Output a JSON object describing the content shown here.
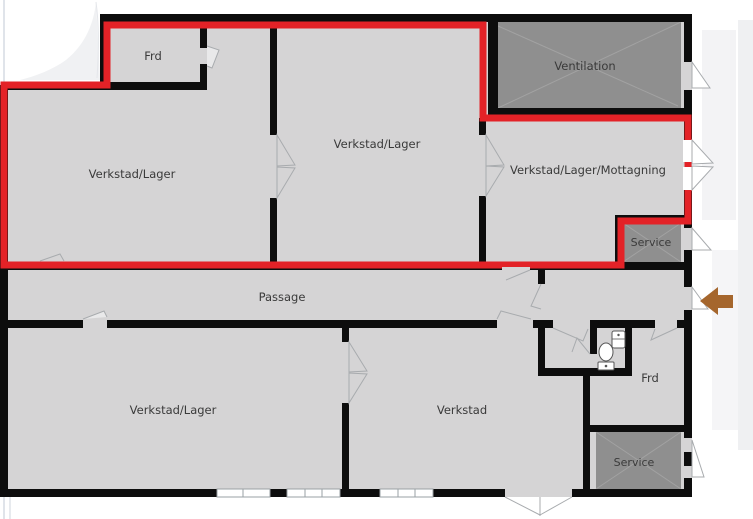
{
  "rooms": [
    {
      "id": "frd-top",
      "label": "Frd"
    },
    {
      "id": "verkstad-lager-left",
      "label": "Verkstad/Lager"
    },
    {
      "id": "verkstad-lager-mid",
      "label": "Verkstad/Lager"
    },
    {
      "id": "ventilation",
      "label": "Ventilation"
    },
    {
      "id": "verkstad-lager-mottagning",
      "label": "Verkstad/Lager/Mottagning"
    },
    {
      "id": "service-top",
      "label": "Service"
    },
    {
      "id": "passage",
      "label": "Passage"
    },
    {
      "id": "verkstad-lager-bottom",
      "label": "Verkstad/Lager"
    },
    {
      "id": "verkstad",
      "label": "Verkstad"
    },
    {
      "id": "frd-bottom",
      "label": "Frd"
    },
    {
      "id": "service-bottom",
      "label": "Service"
    }
  ],
  "colors": {
    "room_fill": "#d5d4d5",
    "utility_room_fill": "#8f8f8f",
    "wall": "#0d0d0d",
    "highlight_outline": "#e32227",
    "entrance_arrow": "#a5662d",
    "door_window_line": "#a8abae",
    "hatch_line": "#a2a2a2",
    "label_text": "#3a3a3a"
  },
  "icons": {
    "entrance_arrow": "arrow-left-icon",
    "wc_toilet": "toilet-icon",
    "wc_sink": "sink-icon"
  }
}
